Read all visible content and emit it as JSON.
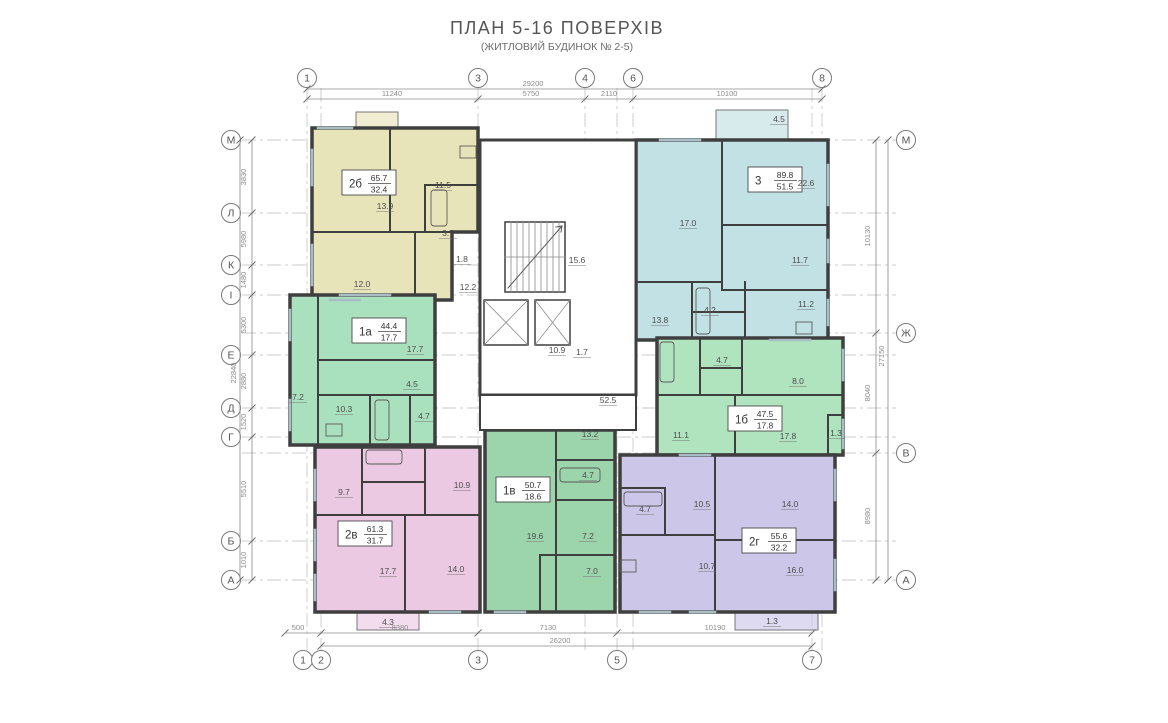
{
  "title": "ПЛАН 5-16 ПОВЕРХІВ",
  "subtitle": "(ЖИТЛОВИЙ БУДИНОК № 2-5)",
  "colors": {
    "wall": "#3f3f3f",
    "grid": "#c9ccce",
    "dim": "#8b8b8b",
    "axis": "#7a7a7a",
    "room_text": "#4d4d4d",
    "window": "#a9bdc4",
    "apt_2b": "#e8e4ba",
    "apt_3": "#c2e1e4",
    "apt_1a": "#a9e0bd",
    "apt_1b": "#b0e4bf",
    "apt_1v": "#9cd4ac",
    "apt_2v": "#ecc9e3",
    "apt_2g": "#ccc6e9"
  },
  "axes": {
    "top": [
      {
        "label": "1",
        "x": 307
      },
      {
        "label": "3",
        "x": 478
      },
      {
        "label": "4",
        "x": 585
      },
      {
        "label": "6",
        "x": 633
      },
      {
        "label": "8",
        "x": 822
      }
    ],
    "bottom": [
      {
        "label": "1",
        "x": 303
      },
      {
        "label": "2",
        "x": 321
      },
      {
        "label": "3",
        "x": 478
      },
      {
        "label": "5",
        "x": 617
      },
      {
        "label": "7",
        "x": 812
      }
    ],
    "left": [
      {
        "label": "М",
        "y": 140
      },
      {
        "label": "Л",
        "y": 213
      },
      {
        "label": "К",
        "y": 265
      },
      {
        "label": "I",
        "y": 295
      },
      {
        "label": "Е",
        "y": 355
      },
      {
        "label": "Д",
        "y": 408
      },
      {
        "label": "Г",
        "y": 437
      },
      {
        "label": "Б",
        "y": 541
      },
      {
        "label": "А",
        "y": 580
      }
    ],
    "right": [
      {
        "label": "М",
        "y": 140
      },
      {
        "label": "Ж",
        "y": 333
      },
      {
        "label": "В",
        "y": 453
      },
      {
        "label": "А",
        "y": 580
      }
    ]
  },
  "dimensions": {
    "top": {
      "overall": "29200",
      "segments": [
        {
          "t": "11240",
          "x": 392
        },
        {
          "t": "5750",
          "x": 531
        },
        {
          "t": "2110",
          "x": 609
        },
        {
          "t": "10100",
          "x": 727
        }
      ]
    },
    "bottom": {
      "overall": "26200",
      "segments": [
        {
          "t": "500",
          "x": 298
        },
        {
          "t": "8380",
          "x": 400
        },
        {
          "t": "7130",
          "x": 548
        },
        {
          "t": "10190",
          "x": 715
        }
      ]
    },
    "left": {
      "overall": "22840",
      "segments": [
        {
          "t": "3830",
          "y": 177
        },
        {
          "t": "5980",
          "y": 239
        },
        {
          "t": "1480",
          "y": 280
        },
        {
          "t": "5300",
          "y": 325
        },
        {
          "t": "2880",
          "y": 381
        },
        {
          "t": "1520",
          "y": 422
        },
        {
          "t": "5510",
          "y": 489
        },
        {
          "t": "1010",
          "y": 560
        }
      ]
    },
    "right": {
      "overall": "27150",
      "segments": [
        {
          "t": "10130",
          "y": 236
        },
        {
          "t": "8040",
          "y": 393
        },
        {
          "t": "8980",
          "y": 516
        }
      ]
    }
  },
  "apartments": [
    {
      "id": "2б",
      "total": "65.7",
      "living": "32.4",
      "color_key": "apt_2b",
      "box": {
        "x": 342,
        "y": 170
      },
      "rooms": [
        {
          "t": "13.9",
          "x": 385,
          "y": 209
        },
        {
          "t": "11.5",
          "x": 443,
          "y": 188
        },
        {
          "t": "3.7",
          "x": 448,
          "y": 236
        },
        {
          "t": "1.8",
          "x": 462,
          "y": 262
        },
        {
          "t": "12.0",
          "x": 362,
          "y": 287
        },
        {
          "t": "12.2",
          "x": 468,
          "y": 290
        }
      ]
    },
    {
      "id": "3",
      "total": "89.8",
      "living": "51.5",
      "color_key": "apt_3",
      "box": {
        "x": 748,
        "y": 167
      },
      "rooms": [
        {
          "t": "4.5",
          "x": 779,
          "y": 122
        },
        {
          "t": "22.6",
          "x": 806,
          "y": 186
        },
        {
          "t": "17.0",
          "x": 688,
          "y": 226
        },
        {
          "t": "11.7",
          "x": 800,
          "y": 263
        },
        {
          "t": "13.8",
          "x": 660,
          "y": 323
        },
        {
          "t": "4.2",
          "x": 710,
          "y": 313
        },
        {
          "t": "11.2",
          "x": 806,
          "y": 307
        }
      ]
    },
    {
      "id": "1а",
      "total": "44.4",
      "living": "17.7",
      "color_key": "apt_1a",
      "box": {
        "x": 352,
        "y": 318
      },
      "rooms": [
        {
          "t": "17.7",
          "x": 415,
          "y": 352
        },
        {
          "t": "4.5",
          "x": 412,
          "y": 387
        },
        {
          "t": "7.2",
          "x": 298,
          "y": 400
        },
        {
          "t": "10.3",
          "x": 344,
          "y": 412
        },
        {
          "t": "4.7",
          "x": 424,
          "y": 419
        }
      ]
    },
    {
      "id": "1б",
      "total": "47.5",
      "living": "17.8",
      "color_key": "apt_1b",
      "box": {
        "x": 728,
        "y": 406
      },
      "rooms": [
        {
          "t": "4.7",
          "x": 722,
          "y": 363
        },
        {
          "t": "8.0",
          "x": 798,
          "y": 384
        },
        {
          "t": "11.1",
          "x": 681,
          "y": 438
        },
        {
          "t": "17.8",
          "x": 788,
          "y": 439
        },
        {
          "t": "1.3",
          "x": 836,
          "y": 436
        }
      ]
    },
    {
      "id": "1в",
      "total": "50.7",
      "living": "18.6",
      "color_key": "apt_1v",
      "box": {
        "x": 496,
        "y": 477
      },
      "rooms": [
        {
          "t": "13.2",
          "x": 590,
          "y": 437
        },
        {
          "t": "4.7",
          "x": 588,
          "y": 478
        },
        {
          "t": "19.6",
          "x": 535,
          "y": 539
        },
        {
          "t": "7.2",
          "x": 588,
          "y": 539
        },
        {
          "t": "7.0",
          "x": 592,
          "y": 574
        }
      ]
    },
    {
      "id": "2в",
      "total": "61.3",
      "living": "31.7",
      "color_key": "apt_2v",
      "box": {
        "x": 338,
        "y": 521
      },
      "rooms": [
        {
          "t": "9.7",
          "x": 344,
          "y": 495
        },
        {
          "t": "10.9",
          "x": 462,
          "y": 488
        },
        {
          "t": "17.7",
          "x": 388,
          "y": 574
        },
        {
          "t": "14.0",
          "x": 456,
          "y": 572
        },
        {
          "t": "4.3",
          "x": 388,
          "y": 625
        }
      ]
    },
    {
      "id": "2г",
      "total": "55.6",
      "living": "32.2",
      "color_key": "apt_2g",
      "box": {
        "x": 742,
        "y": 528
      },
      "rooms": [
        {
          "t": "10.5",
          "x": 702,
          "y": 507
        },
        {
          "t": "14.0",
          "x": 790,
          "y": 507
        },
        {
          "t": "4.7",
          "x": 645,
          "y": 512
        },
        {
          "t": "10.7",
          "x": 707,
          "y": 569
        },
        {
          "t": "16.0",
          "x": 795,
          "y": 573
        },
        {
          "t": "1.3",
          "x": 772,
          "y": 624
        }
      ]
    }
  ],
  "core": {
    "rooms": [
      {
        "t": "15.6",
        "x": 577,
        "y": 263
      },
      {
        "t": "10.9",
        "x": 557,
        "y": 353
      },
      {
        "t": "1.7",
        "x": 582,
        "y": 355
      },
      {
        "t": "52.5",
        "x": 608,
        "y": 403
      }
    ]
  }
}
